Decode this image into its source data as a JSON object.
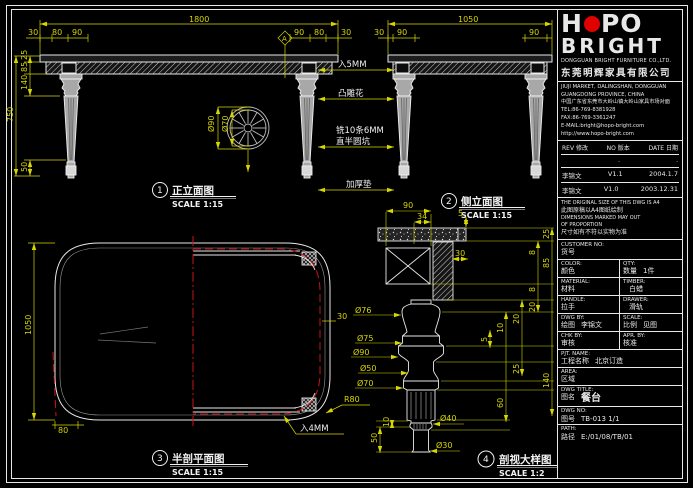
{
  "colors": {
    "background": "#000000",
    "line_white": "#e8e8e8",
    "dim_yellow": "#d6d600",
    "centerline_red": "#c81414",
    "logo_red": "#e00000"
  },
  "views": {
    "front": {
      "number": "1",
      "title": "正立面图",
      "scale": "SCALE 1:15",
      "section_marker": "A",
      "dims": {
        "total_width": "1800",
        "left_margin": "30",
        "seg_80l": "80",
        "seg_90l": "90",
        "seg_90r": "90",
        "seg_80r": "80",
        "right_margin": "30",
        "top_thk": "25",
        "apron_h": "85",
        "leg_top": "140",
        "total_h": "750",
        "foot_h": "50",
        "wheel_outer": "Ø90",
        "wheel_inner": "Ø70"
      }
    },
    "side": {
      "number": "2",
      "title": "侧立面图",
      "scale": "SCALE 1:15",
      "dims": {
        "total_width": "1050",
        "left_margin": "30",
        "leg_l": "90",
        "leg_r": "90"
      }
    },
    "plan": {
      "number": "3",
      "title": "半剖平面图",
      "scale": "SCALE 1:15",
      "callout_tenon": "入4MM",
      "dims": {
        "depth": "1050",
        "corner": "80",
        "edge": "30",
        "radius": "R80"
      }
    },
    "detail": {
      "number": "4",
      "title": "剖视大样图",
      "scale": "SCALE 1:2",
      "dims": {
        "top_90": "90",
        "top_34": "34",
        "top_5": "5",
        "box_30": "30",
        "r_25a": "25",
        "r_85": "85",
        "r_140": "140",
        "r_8a": "8",
        "r_8b": "8",
        "r_20a": "20",
        "r_20b": "20",
        "r_25b": "25",
        "r_10": "10",
        "r_60": "60",
        "r_5": "5",
        "d76": "Ø76",
        "d75": "Ø75",
        "d90": "Ø90",
        "d50": "Ø50",
        "d70": "Ø70",
        "b_50": "50",
        "b_10": "10",
        "d40": "Ø40",
        "d30": "Ø30"
      }
    }
  },
  "callouts": {
    "tenon5": "入5MM",
    "carving": "凸雕花",
    "groove_line1": "铣10条6MM",
    "groove_line2": "直半圆坑",
    "pad": "加厚垫"
  },
  "titleblock": {
    "logo": {
      "h": "H",
      "po": "PO",
      "bright": "BRIGHT"
    },
    "company_en": "DONGGUAN BRIGHT FURNITURE CO.,LTD.",
    "company_cn": "东莞明辉家具有限公司",
    "address": [
      "JIUJI MARKET, DALINGSHAN, DONGGUAN",
      "GUANGDONG PROVINCE, CHINA",
      "中国广东省东莞市大岭山镇大岭山家具市场对面",
      "TEL:86-769-8381928",
      "FAX:86-769-3361247",
      "E-MAIL:bright@hopo-bright.com",
      "http://www.hopo-bright.com"
    ],
    "rev_table": {
      "header": {
        "rev": "REV 修改",
        "no": "NO 版本",
        "date": "DATE 日期"
      },
      "rows": [
        {
          "name": "",
          "ver": ".",
          "date": "."
        },
        {
          "name": "李锦文",
          "ver": "V1.1",
          "date": "2004.1.7"
        },
        {
          "name": "李锦文",
          "ver": "V1.0",
          "date": "2003.12.31"
        }
      ]
    },
    "notes": [
      "THE ORIGINAL SIZE OF THIS DWG IS A4",
      "此图原稿以A4图纸绘制",
      "DIMENSIONS MARKED MAY OUT",
      "OF PROPORTION",
      "尺寸如有不符以实物为准"
    ],
    "fields": {
      "customer_no": {
        "en": "CUSTOMER NO:",
        "cn": "货号",
        "val": ""
      },
      "color": {
        "en": "COLOR:",
        "cn": "颜色",
        "val": ""
      },
      "qty": {
        "en": "QTY:",
        "cn": "数量",
        "val": "1件"
      },
      "material": {
        "en": "MATERIAL:",
        "cn": "材料",
        "val": ""
      },
      "timber": {
        "en": "TIMBER:",
        "cn": "",
        "val": "白蜡"
      },
      "handle": {
        "en": "HANDLE:",
        "cn": "拉手",
        "val": ""
      },
      "drawer": {
        "en": "DRAWER:",
        "cn": "",
        "val": "滑轨"
      },
      "dwg_by": {
        "en": "DWG BY:",
        "cn": "绘图",
        "val": "李锦文"
      },
      "scale": {
        "en": "SCALE:",
        "cn": "比例",
        "val": "见图"
      },
      "chk_by": {
        "en": "CHK BY:",
        "cn": "审核",
        "val": ""
      },
      "apr_by": {
        "en": "APR. BY:",
        "cn": "核准",
        "val": ""
      },
      "pjt_name": {
        "en": "PJT. NAME:",
        "cn": "工程名称",
        "val": "北京订造"
      },
      "area": {
        "en": "AREA:",
        "cn": "区域",
        "val": ""
      },
      "dwg_title": {
        "en": "DWG TITLE:",
        "cn": "图名",
        "val": "餐台"
      },
      "dwg_no": {
        "en": "DWG NO:",
        "cn": "图号",
        "val": "TB-013  1/1"
      },
      "path": {
        "en": "PATH:",
        "cn": "路径",
        "val": "E:/01/08/TB/01"
      }
    }
  }
}
